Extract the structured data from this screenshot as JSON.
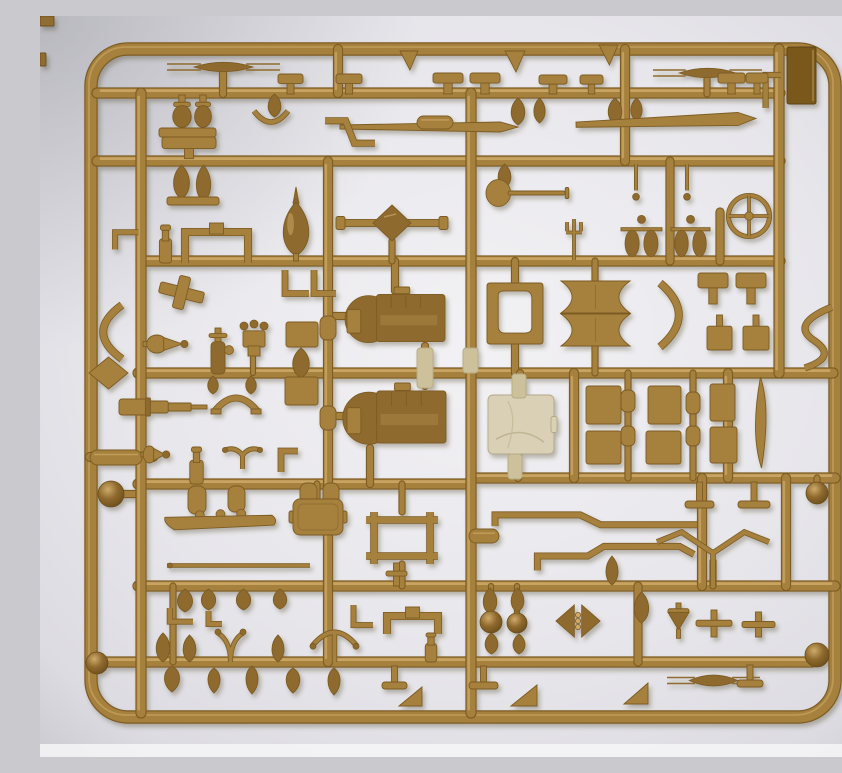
{
  "meta": {
    "description": "Photograph of a tan injection-molded plastic model kit sprue (parts tree) with many small vehicle parts, on a pale gray background"
  },
  "palette": {
    "tan_main": "#a6803e",
    "tan_light": "#cfab6a",
    "tan_dark": "#7c5b23",
    "tan_deep": "#8f6a2e",
    "gate": "#cdc19b",
    "canvas": "#d9d0b6",
    "panel": "#7a591f",
    "bg_center": "#f2f1f4",
    "bg_mid": "#e7e6eb",
    "bg_edge": "#c9c8cf",
    "bg_bottom": "#f6f6f8"
  },
  "frame": {
    "x": 51,
    "y": 33,
    "w": 744,
    "h": 668,
    "rx": 37,
    "sw": 11
  },
  "runners_h": [
    {
      "x1": 57,
      "y": 77,
      "x2": 740,
      "w": 9
    },
    {
      "x1": 57,
      "y": 145,
      "x2": 740,
      "w": 9
    },
    {
      "x1": 101,
      "y": 245,
      "x2": 740,
      "w": 9
    },
    {
      "x1": 98,
      "y": 357,
      "x2": 793,
      "w": 9
    },
    {
      "x1": 50,
      "y": 441,
      "x2": 113,
      "w": 8
    },
    {
      "x1": 98,
      "y": 468,
      "x2": 431,
      "w": 9
    },
    {
      "x1": 431,
      "y": 462,
      "x2": 795,
      "w": 9
    },
    {
      "x1": 98,
      "y": 570,
      "x2": 795,
      "w": 9
    },
    {
      "x1": 62,
      "y": 646,
      "x2": 772,
      "w": 9
    },
    {
      "x1": 71,
      "y": 478,
      "x2": 101,
      "w": 6
    },
    {
      "x1": 288,
      "y": 300,
      "x2": 310,
      "w": 6
    },
    {
      "x1": 288,
      "y": 400,
      "x2": 310,
      "w": 6
    }
  ],
  "runners_v": [
    {
      "x": 101,
      "y1": 77,
      "y2": 697,
      "w": 9
    },
    {
      "x": 298,
      "y1": 33,
      "y2": 77,
      "w": 8
    },
    {
      "x": 288,
      "y1": 145,
      "y2": 646,
      "w": 8
    },
    {
      "x": 431,
      "y1": 77,
      "y2": 697,
      "w": 9
    },
    {
      "x": 585,
      "y1": 33,
      "y2": 145,
      "w": 8
    },
    {
      "x": 630,
      "y1": 145,
      "y2": 245,
      "w": 7
    },
    {
      "x": 739,
      "y1": 33,
      "y2": 357,
      "w": 9
    },
    {
      "x": 534,
      "y1": 357,
      "y2": 462,
      "w": 8
    },
    {
      "x": 588,
      "y1": 357,
      "y2": 462,
      "w": 5
    },
    {
      "x": 653,
      "y1": 357,
      "y2": 462,
      "w": 5
    },
    {
      "x": 688,
      "y1": 357,
      "y2": 462,
      "w": 8
    },
    {
      "x": 662,
      "y1": 462,
      "y2": 570,
      "w": 8
    },
    {
      "x": 746,
      "y1": 462,
      "y2": 570,
      "w": 8
    },
    {
      "x": 598,
      "y1": 570,
      "y2": 646,
      "w": 7
    },
    {
      "x": 680,
      "y1": 196,
      "y2": 245,
      "w": 7
    },
    {
      "x": 183,
      "y1": 57,
      "y2": 78,
      "w": 6
    },
    {
      "x": 667,
      "y1": 63,
      "y2": 78,
      "w": 5
    },
    {
      "x": 777,
      "y1": 462,
      "y2": 470,
      "w": 5
    },
    {
      "x": 475,
      "y1": 245,
      "y2": 268,
      "w": 6
    },
    {
      "x": 475,
      "y1": 328,
      "y2": 357,
      "w": 6
    },
    {
      "x": 480,
      "y1": 357,
      "y2": 380,
      "w": 6
    },
    {
      "x": 478,
      "y1": 438,
      "y2": 462,
      "w": 6
    },
    {
      "x": 355,
      "y1": 245,
      "y2": 275,
      "w": 6
    },
    {
      "x": 385,
      "y1": 330,
      "y2": 370,
      "w": 6
    },
    {
      "x": 330,
      "y1": 432,
      "y2": 468,
      "w": 6
    },
    {
      "x": 555,
      "y1": 245,
      "y2": 265,
      "w": 5
    },
    {
      "x": 555,
      "y1": 330,
      "y2": 357,
      "w": 5
    },
    {
      "x": 362,
      "y1": 468,
      "y2": 496,
      "w": 5
    },
    {
      "x": 362,
      "y1": 548,
      "y2": 570,
      "w": 5
    },
    {
      "x": 277,
      "y1": 468,
      "y2": 483,
      "w": 5
    },
    {
      "x": 352,
      "y1": 225,
      "y2": 245,
      "w": 5
    },
    {
      "x": 451,
      "y1": 570,
      "y2": 598,
      "w": 4
    },
    {
      "x": 477,
      "y1": 570,
      "y2": 598,
      "w": 4
    },
    {
      "x": 673,
      "y1": 545,
      "y2": 570,
      "w": 5
    },
    {
      "x": 133,
      "y1": 570,
      "y2": 646,
      "w": 5
    },
    {
      "x": 213,
      "y1": 338,
      "y2": 357,
      "w": 4
    }
  ],
  "balls": [
    {
      "x": 71,
      "y": 478,
      "r": 13
    },
    {
      "x": 57,
      "y": 647,
      "r": 11
    },
    {
      "x": 777,
      "y": 639,
      "r": 12
    },
    {
      "x": 777,
      "y": 477,
      "r": 11
    },
    {
      "x": 451,
      "y": 606,
      "r": 11
    },
    {
      "x": 477,
      "y": 607,
      "r": 10
    }
  ],
  "parts": [
    {
      "t": "scrap",
      "x": 0,
      "y": 0,
      "w": 14,
      "h": 10
    },
    {
      "t": "scrap",
      "x": 0,
      "y": 37,
      "w": 6,
      "h": 13
    },
    {
      "t": "panel",
      "x": 747,
      "y": 31,
      "w": 29,
      "h": 57
    },
    {
      "t": "spring",
      "x": 127,
      "y": 42,
      "w": 113,
      "h": 18
    },
    {
      "t": "spring",
      "x": 613,
      "y": 48,
      "w": 109,
      "h": 18
    },
    {
      "t": "spring",
      "x": 627,
      "y": 654,
      "w": 93,
      "h": 21
    },
    {
      "t": "flag",
      "x": 360,
      "y": 35,
      "w": 18,
      "h": 19
    },
    {
      "t": "flag",
      "x": 465,
      "y": 35,
      "w": 20,
      "h": 21
    },
    {
      "t": "flag",
      "x": 559,
      "y": 29,
      "w": 19,
      "h": 20
    },
    {
      "t": "lstub",
      "x": 719,
      "y": 56,
      "w": 22,
      "h": 36
    },
    {
      "t": "tvalve",
      "x": 131,
      "y": 79,
      "w": 22,
      "h": 33
    },
    {
      "t": "tvalve",
      "x": 153,
      "y": 79,
      "w": 20,
      "h": 33
    },
    {
      "t": "bar",
      "x": 119,
      "y": 112,
      "w": 57,
      "h": 9
    },
    {
      "t": "arcclip",
      "x": 214,
      "y": 93,
      "w": 34,
      "h": 16
    },
    {
      "t": "bulb",
      "x": 226,
      "y": 78,
      "w": 17,
      "h": 23
    },
    {
      "t": "ttop",
      "x": 238,
      "y": 58,
      "w": 25,
      "h": 20
    },
    {
      "t": "ttop",
      "x": 296,
      "y": 58,
      "w": 26,
      "h": 20
    },
    {
      "t": "ttop",
      "x": 393,
      "y": 57,
      "w": 30,
      "h": 21
    },
    {
      "t": "ttop",
      "x": 430,
      "y": 57,
      "w": 30,
      "h": 21
    },
    {
      "t": "ttop",
      "x": 499,
      "y": 59,
      "w": 28,
      "h": 19
    },
    {
      "t": "ttop",
      "x": 540,
      "y": 59,
      "w": 23,
      "h": 19
    },
    {
      "t": "ttop",
      "x": 678,
      "y": 57,
      "w": 27,
      "h": 21
    },
    {
      "t": "ttop",
      "x": 706,
      "y": 57,
      "w": 22,
      "h": 21
    },
    {
      "t": "bulb",
      "x": 469,
      "y": 82,
      "w": 18,
      "h": 27
    },
    {
      "t": "bulb",
      "x": 492,
      "y": 82,
      "w": 15,
      "h": 25
    },
    {
      "t": "bulb",
      "x": 566,
      "y": 82,
      "w": 18,
      "h": 26
    },
    {
      "t": "bulb",
      "x": 589,
      "y": 82,
      "w": 15,
      "h": 23
    },
    {
      "t": "rod",
      "x": 300,
      "y": 106,
      "w": 178,
      "h": 10
    },
    {
      "t": "capsule",
      "x": 377,
      "y": 100,
      "w": 36,
      "h": 13
    },
    {
      "t": "rod",
      "x": 536,
      "y": 99,
      "w": 180,
      "h": 13,
      "r": -2
    },
    {
      "t": "zpipe",
      "x": 283,
      "y": 96,
      "w": 54,
      "h": 40
    },
    {
      "t": "widecap",
      "x": 122,
      "y": 121,
      "w": 54,
      "h": 21
    },
    {
      "t": "bulb",
      "x": 131,
      "y": 149,
      "w": 21,
      "h": 34
    },
    {
      "t": "bulb",
      "x": 154,
      "y": 149,
      "w": 19,
      "h": 37
    },
    {
      "t": "bar",
      "x": 127,
      "y": 181,
      "w": 52,
      "h": 8
    },
    {
      "t": "bulb",
      "x": 456,
      "y": 148,
      "w": 17,
      "h": 24
    },
    {
      "t": "needle",
      "x": 590,
      "y": 148,
      "w": 12,
      "h": 40
    },
    {
      "t": "needle",
      "x": 641,
      "y": 148,
      "w": 12,
      "h": 40
    },
    {
      "t": "shovel",
      "x": 446,
      "y": 163,
      "w": 88,
      "h": 28
    },
    {
      "t": "fork",
      "x": 523,
      "y": 203,
      "w": 22,
      "h": 41
    },
    {
      "t": "staple",
      "x": 142,
      "y": 207,
      "w": 69,
      "h": 40
    },
    {
      "t": "bottle",
      "x": 116,
      "y": 209,
      "w": 19,
      "h": 38
    },
    {
      "t": "finial",
      "x": 239,
      "y": 171,
      "w": 34,
      "h": 74
    },
    {
      "t": "axle",
      "x": 296,
      "y": 189,
      "w": 112,
      "h": 36
    },
    {
      "t": "pulleyasm",
      "x": 578,
      "y": 196,
      "w": 47,
      "h": 49
    },
    {
      "t": "pulleyasm",
      "x": 628,
      "y": 196,
      "w": 45,
      "h": 49
    },
    {
      "t": "wheel",
      "x": 687,
      "y": 178,
      "w": 44,
      "h": 44
    },
    {
      "t": "elbow",
      "x": 243,
      "y": 252,
      "w": 28,
      "h": 28
    },
    {
      "t": "elbow",
      "x": 272,
      "y": 252,
      "w": 26,
      "h": 28
    },
    {
      "t": "cross",
      "x": 119,
      "y": 260,
      "w": 45,
      "h": 33,
      "r": 14
    },
    {
      "t": "engine",
      "x": 307,
      "y": 274,
      "w": 98,
      "h": 56
    },
    {
      "t": "engine",
      "x": 307,
      "y": 370,
      "w": 99,
      "h": 62
    },
    {
      "t": "holeplate",
      "x": 447,
      "y": 267,
      "w": 56,
      "h": 61
    },
    {
      "t": "canvas",
      "x": 448,
      "y": 379,
      "w": 66,
      "h": 59
    },
    {
      "t": "tearR",
      "x": 103,
      "y": 318,
      "w": 46,
      "h": 20
    },
    {
      "t": "crescent",
      "x": 56,
      "y": 287,
      "w": 29,
      "h": 58
    },
    {
      "t": "diamond",
      "x": 49,
      "y": 341,
      "w": 39,
      "h": 32
    },
    {
      "t": "carb",
      "x": 162,
      "y": 312,
      "w": 32,
      "h": 46
    },
    {
      "t": "crown",
      "x": 197,
      "y": 304,
      "w": 34,
      "h": 36
    },
    {
      "t": "bulb",
      "x": 166,
      "y": 360,
      "w": 14,
      "h": 18
    },
    {
      "t": "bulb",
      "x": 204,
      "y": 360,
      "w": 14,
      "h": 18
    },
    {
      "t": "arch",
      "x": 171,
      "y": 374,
      "w": 50,
      "h": 25
    },
    {
      "t": "box",
      "x": 246,
      "y": 306,
      "w": 32,
      "h": 25
    },
    {
      "t": "bulb",
      "x": 250,
      "y": 332,
      "w": 22,
      "h": 30
    },
    {
      "t": "box",
      "x": 245,
      "y": 361,
      "w": 33,
      "h": 28
    },
    {
      "t": "telescope",
      "x": 79,
      "y": 382,
      "w": 88,
      "h": 18
    },
    {
      "t": "spool",
      "x": 521,
      "y": 265,
      "w": 69,
      "h": 32
    },
    {
      "t": "spool",
      "x": 521,
      "y": 298,
      "w": 69,
      "h": 32
    },
    {
      "t": "crescent",
      "x": 617,
      "y": 265,
      "w": 29,
      "h": 68,
      "r": 180
    },
    {
      "t": "ttop",
      "x": 658,
      "y": 257,
      "w": 30,
      "h": 31
    },
    {
      "t": "ttop",
      "x": 696,
      "y": 257,
      "w": 30,
      "h": 31
    },
    {
      "t": "boxstem",
      "x": 667,
      "y": 299,
      "w": 25,
      "h": 35
    },
    {
      "t": "boxstem",
      "x": 703,
      "y": 299,
      "w": 26,
      "h": 35
    },
    {
      "t": "spipe",
      "x": 755,
      "y": 289,
      "w": 39,
      "h": 65
    },
    {
      "t": "barrel",
      "x": 280,
      "y": 300,
      "w": 16,
      "h": 24
    },
    {
      "t": "barrel",
      "x": 280,
      "y": 390,
      "w": 16,
      "h": 24
    },
    {
      "t": "gate",
      "x": 377,
      "y": 332,
      "w": 16,
      "h": 40
    },
    {
      "t": "gate",
      "x": 423,
      "y": 332,
      "w": 15,
      "h": 25
    },
    {
      "t": "box",
      "x": 546,
      "y": 370,
      "w": 35,
      "h": 38
    },
    {
      "t": "box",
      "x": 608,
      "y": 370,
      "w": 33,
      "h": 38
    },
    {
      "t": "box",
      "x": 546,
      "y": 415,
      "w": 35,
      "h": 33
    },
    {
      "t": "box",
      "x": 606,
      "y": 415,
      "w": 35,
      "h": 33
    },
    {
      "t": "trapbox",
      "x": 670,
      "y": 368,
      "w": 25,
      "h": 37
    },
    {
      "t": "trapbox",
      "x": 670,
      "y": 411,
      "w": 27,
      "h": 36
    },
    {
      "t": "leafv",
      "x": 710,
      "y": 361,
      "w": 21,
      "h": 91
    },
    {
      "t": "barrel",
      "x": 581,
      "y": 374,
      "w": 14,
      "h": 22
    },
    {
      "t": "barrel",
      "x": 646,
      "y": 376,
      "w": 14,
      "h": 22
    },
    {
      "t": "barrel",
      "x": 581,
      "y": 410,
      "w": 14,
      "h": 20
    },
    {
      "t": "barrel",
      "x": 646,
      "y": 410,
      "w": 14,
      "h": 20
    },
    {
      "t": "capsule",
      "x": 50,
      "y": 434,
      "w": 52,
      "h": 15
    },
    {
      "t": "tearR",
      "x": 101,
      "y": 429,
      "w": 28,
      "h": 19
    },
    {
      "t": "bottle",
      "x": 146,
      "y": 431,
      "w": 21,
      "h": 37
    },
    {
      "t": "vwings",
      "x": 182,
      "y": 428,
      "w": 41,
      "h": 25
    },
    {
      "t": "elbow2",
      "x": 239,
      "y": 431,
      "w": 21,
      "h": 27
    },
    {
      "t": "barrel",
      "x": 148,
      "y": 470,
      "w": 18,
      "h": 28
    },
    {
      "t": "barrel",
      "x": 188,
      "y": 470,
      "w": 17,
      "h": 26
    },
    {
      "t": "barrel",
      "x": 260,
      "y": 467,
      "w": 17,
      "h": 31
    },
    {
      "t": "barrel",
      "x": 283,
      "y": 467,
      "w": 16,
      "h": 29
    },
    {
      "t": "boat",
      "x": 123,
      "y": 493,
      "w": 115,
      "h": 26
    },
    {
      "t": "satchel",
      "x": 253,
      "y": 483,
      "w": 50,
      "h": 36
    },
    {
      "t": "ladder",
      "x": 326,
      "y": 496,
      "w": 72,
      "h": 52
    },
    {
      "t": "pipe1",
      "x": 452,
      "y": 488,
      "w": 205,
      "h": 26
    },
    {
      "t": "pipe2",
      "x": 474,
      "y": 524,
      "w": 180,
      "h": 32
    },
    {
      "t": "tfoot",
      "x": 645,
      "y": 466,
      "w": 29,
      "h": 26
    },
    {
      "t": "tfoot",
      "x": 698,
      "y": 466,
      "w": 32,
      "h": 26
    },
    {
      "t": "capsule",
      "x": 429,
      "y": 513,
      "w": 30,
      "h": 14
    },
    {
      "t": "thinrod",
      "x": 127,
      "y": 546,
      "w": 143,
      "h": 7
    },
    {
      "t": "antenna",
      "x": 617,
      "y": 515,
      "w": 112,
      "h": 55
    },
    {
      "t": "bulb",
      "x": 564,
      "y": 540,
      "w": 16,
      "h": 29
    },
    {
      "t": "smallT",
      "x": 346,
      "y": 547,
      "w": 21,
      "h": 23
    },
    {
      "t": "bulb",
      "x": 135,
      "y": 573,
      "w": 20,
      "h": 23
    },
    {
      "t": "bulb",
      "x": 159,
      "y": 573,
      "w": 19,
      "h": 21
    },
    {
      "t": "bulb",
      "x": 194,
      "y": 573,
      "w": 19,
      "h": 21
    },
    {
      "t": "bulb",
      "x": 231,
      "y": 573,
      "w": 18,
      "h": 20
    },
    {
      "t": "hook",
      "x": 122,
      "y": 592,
      "w": 31,
      "h": 21
    },
    {
      "t": "hook",
      "x": 164,
      "y": 595,
      "w": 18,
      "h": 20
    },
    {
      "t": "staple",
      "x": 344,
      "y": 591,
      "w": 57,
      "h": 27
    },
    {
      "t": "hook",
      "x": 307,
      "y": 589,
      "w": 26,
      "h": 31
    },
    {
      "t": "bulb",
      "x": 441,
      "y": 572,
      "w": 18,
      "h": 26
    },
    {
      "t": "bulb",
      "x": 469,
      "y": 572,
      "w": 17,
      "h": 24
    },
    {
      "t": "bulb",
      "x": 443,
      "y": 617,
      "w": 17,
      "h": 21
    },
    {
      "t": "bulb",
      "x": 471,
      "y": 618,
      "w": 16,
      "h": 20
    },
    {
      "t": "mg",
      "x": 515,
      "y": 586,
      "w": 46,
      "h": 38
    },
    {
      "t": "bulb",
      "x": 592,
      "y": 576,
      "w": 19,
      "h": 31
    },
    {
      "t": "conebomb",
      "x": 626,
      "y": 587,
      "w": 25,
      "h": 36
    },
    {
      "t": "crossT",
      "x": 656,
      "y": 594,
      "w": 36,
      "h": 27
    },
    {
      "t": "crossT",
      "x": 702,
      "y": 596,
      "w": 33,
      "h": 25
    },
    {
      "t": "bulb",
      "x": 114,
      "y": 617,
      "w": 18,
      "h": 29
    },
    {
      "t": "bulb",
      "x": 141,
      "y": 619,
      "w": 17,
      "h": 27
    },
    {
      "t": "wishbone",
      "x": 174,
      "y": 612,
      "w": 33,
      "h": 34
    },
    {
      "t": "bulb",
      "x": 230,
      "y": 619,
      "w": 16,
      "h": 27
    },
    {
      "t": "handlebar",
      "x": 270,
      "y": 611,
      "w": 49,
      "h": 35
    },
    {
      "t": "bulb",
      "x": 122,
      "y": 650,
      "w": 20,
      "h": 26,
      "r": 180
    },
    {
      "t": "bulb",
      "x": 166,
      "y": 652,
      "w": 16,
      "h": 25,
      "r": 180
    },
    {
      "t": "bulb",
      "x": 204,
      "y": 650,
      "w": 16,
      "h": 28,
      "r": 180
    },
    {
      "t": "bulb",
      "x": 244,
      "y": 652,
      "w": 18,
      "h": 25,
      "r": 180
    },
    {
      "t": "bulb",
      "x": 286,
      "y": 652,
      "w": 16,
      "h": 27,
      "r": 180
    },
    {
      "t": "bottle",
      "x": 382,
      "y": 617,
      "w": 18,
      "h": 29
    },
    {
      "t": "tfoot",
      "x": 342,
      "y": 650,
      "w": 25,
      "h": 23
    },
    {
      "t": "tfoot",
      "x": 429,
      "y": 650,
      "w": 29,
      "h": 23
    },
    {
      "t": "tfoot",
      "x": 697,
      "y": 649,
      "w": 26,
      "h": 22
    },
    {
      "t": "wedge",
      "x": 359,
      "y": 671,
      "w": 23,
      "h": 19
    },
    {
      "t": "wedge",
      "x": 471,
      "y": 669,
      "w": 26,
      "h": 21
    },
    {
      "t": "wedge",
      "x": 584,
      "y": 667,
      "w": 24,
      "h": 21
    },
    {
      "t": "hook",
      "x": 69,
      "y": 204,
      "w": 23,
      "h": 36,
      "r": 90
    },
    {
      "t": "gate",
      "x": 472,
      "y": 358,
      "w": 14,
      "h": 24
    },
    {
      "t": "gate",
      "x": 468,
      "y": 438,
      "w": 14,
      "h": 25
    }
  ]
}
